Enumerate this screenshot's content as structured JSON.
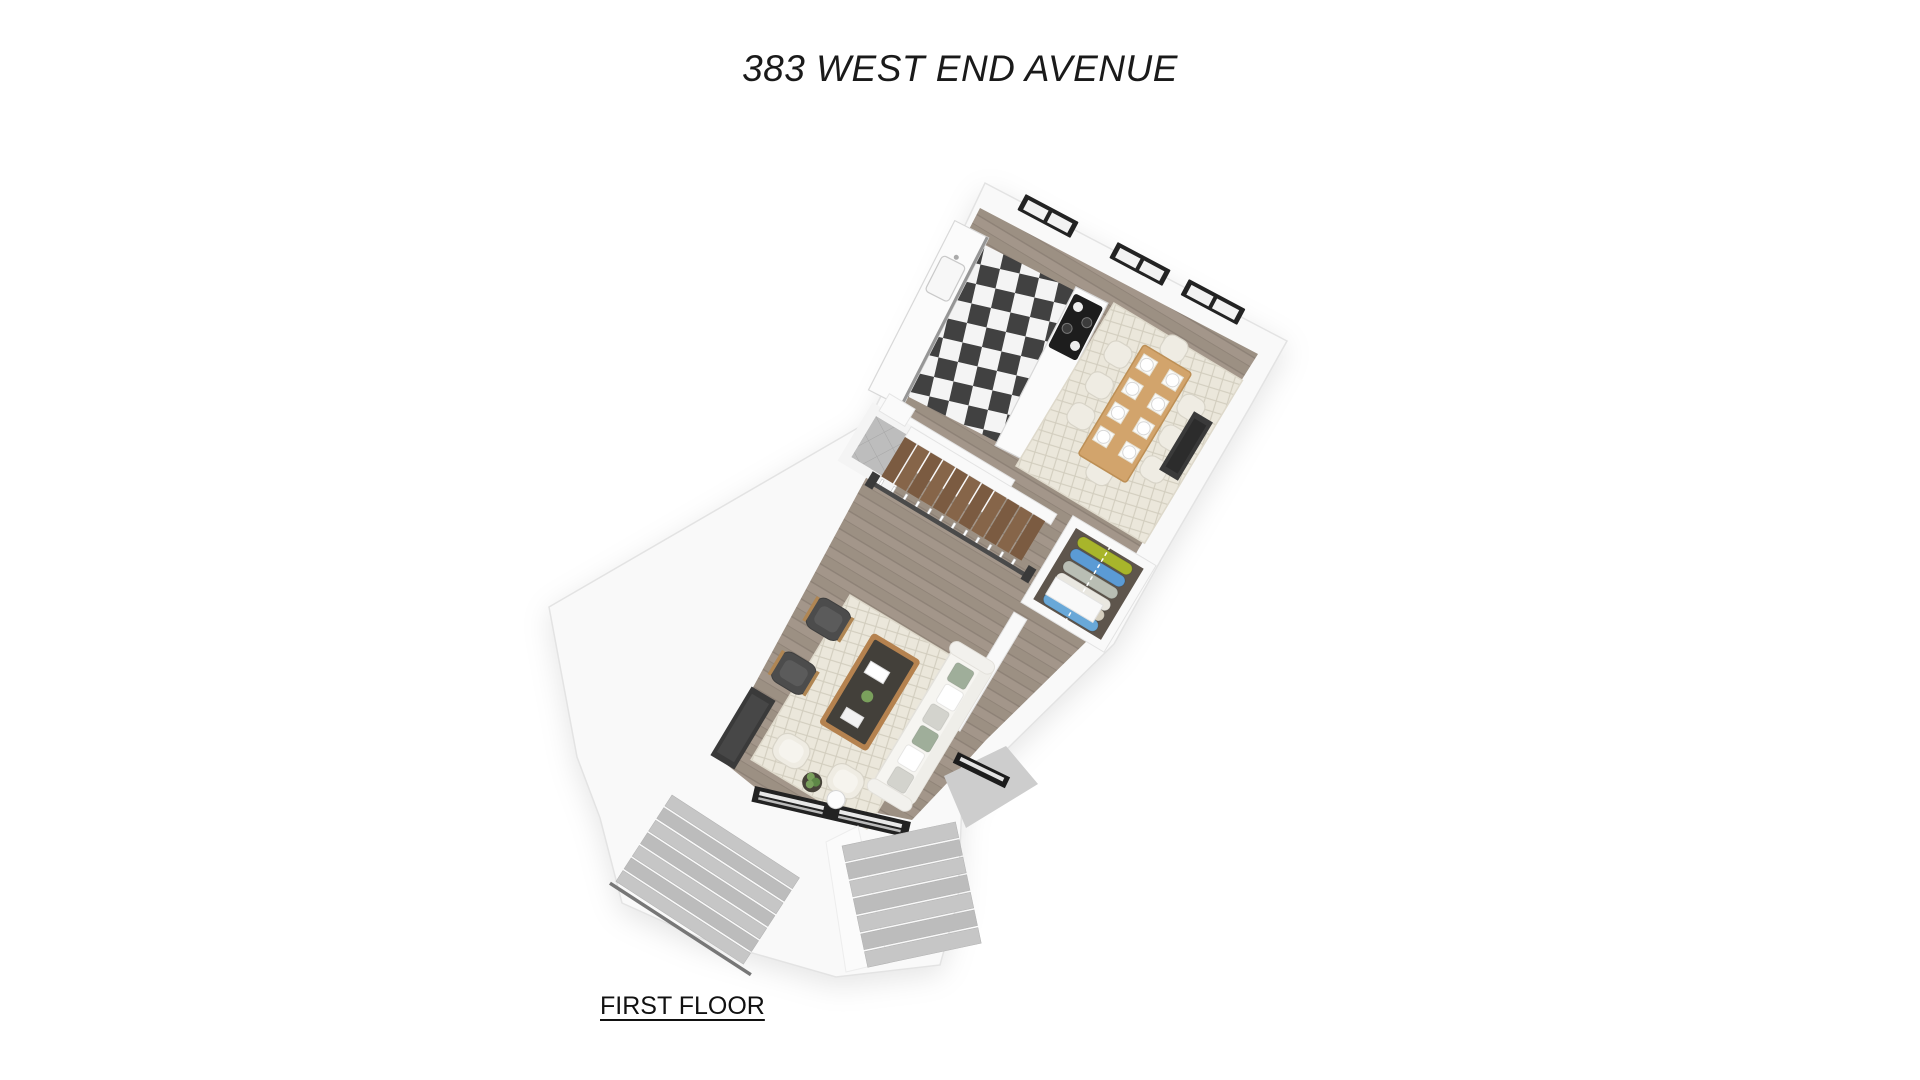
{
  "title": "383 WEST END AVENUE",
  "floor_label": "FIRST FLOOR",
  "rooms": [
    "kitchen",
    "dining room",
    "hall with staircase",
    "powder room",
    "coat closet",
    "living room",
    "entry foyer",
    "front stoop"
  ],
  "counts": {
    "dining_chairs": 8,
    "place_settings": 8,
    "coats": 6,
    "rear_windows": 3
  },
  "palette": {
    "background": "#ffffff",
    "text": "#1a1a1a",
    "wall": "#f9f9f9",
    "wall_edge": "#e3e3e3",
    "wood_floor": "#a3968a",
    "wood_floor_line": "#8d8176",
    "checker_dark": "#414141",
    "checker_light": "#f4f4f4",
    "marble": "#fbfbfb",
    "counter_edge": "#d8d8d8",
    "counter_face": "#969696",
    "cooktop": "#1d1d1d",
    "rug": "#ebe7db",
    "rug_line": "#d2cdbe",
    "rug_edge": "#ded9cb",
    "dining_table_wood": "#d2a46c",
    "dining_table_edge": "#bd8f55",
    "chair_cream": "#efece3",
    "chair_edge": "#d8d4c8",
    "sofa": "#f6f5f1",
    "sofa_edge": "#e3e1db",
    "pillow_sage": "#9fae9a",
    "pillow_gray": "#d3d3cd",
    "pillow_white": "#ffffff",
    "armchair": "#4c4c4c",
    "armchair_seat": "#5b5b5b",
    "armchair_wood": "#b08653",
    "fixture_dark": "#3a3a3a",
    "fixture_inner": "#2c2c2c",
    "stair_wood": "#7b5b41",
    "stair_wood_alt": "#866549",
    "handrail": "#4a4a4a",
    "baluster": "#ffffff",
    "concrete": "#c6c6c6",
    "concrete_alt": "#bcbcbc",
    "tile": "#bdbdbd",
    "tile_line": "#a6a6a6",
    "closet_floor": "#5e554c",
    "coat_colors": [
      "#a8b52b",
      "#5b9bd5",
      "#b9beb4",
      "#e9e7e0",
      "#d6cfbf",
      "#69a8d8"
    ],
    "window_frame": "#232323",
    "window_pane": "#f2f2f2",
    "plant_green": "#7aa05c",
    "plant_green_dark": "#5e8747",
    "coffee_table_wood": "#b5824f",
    "table_top_dark": "#43403a",
    "side_table_dark": "#474239"
  }
}
